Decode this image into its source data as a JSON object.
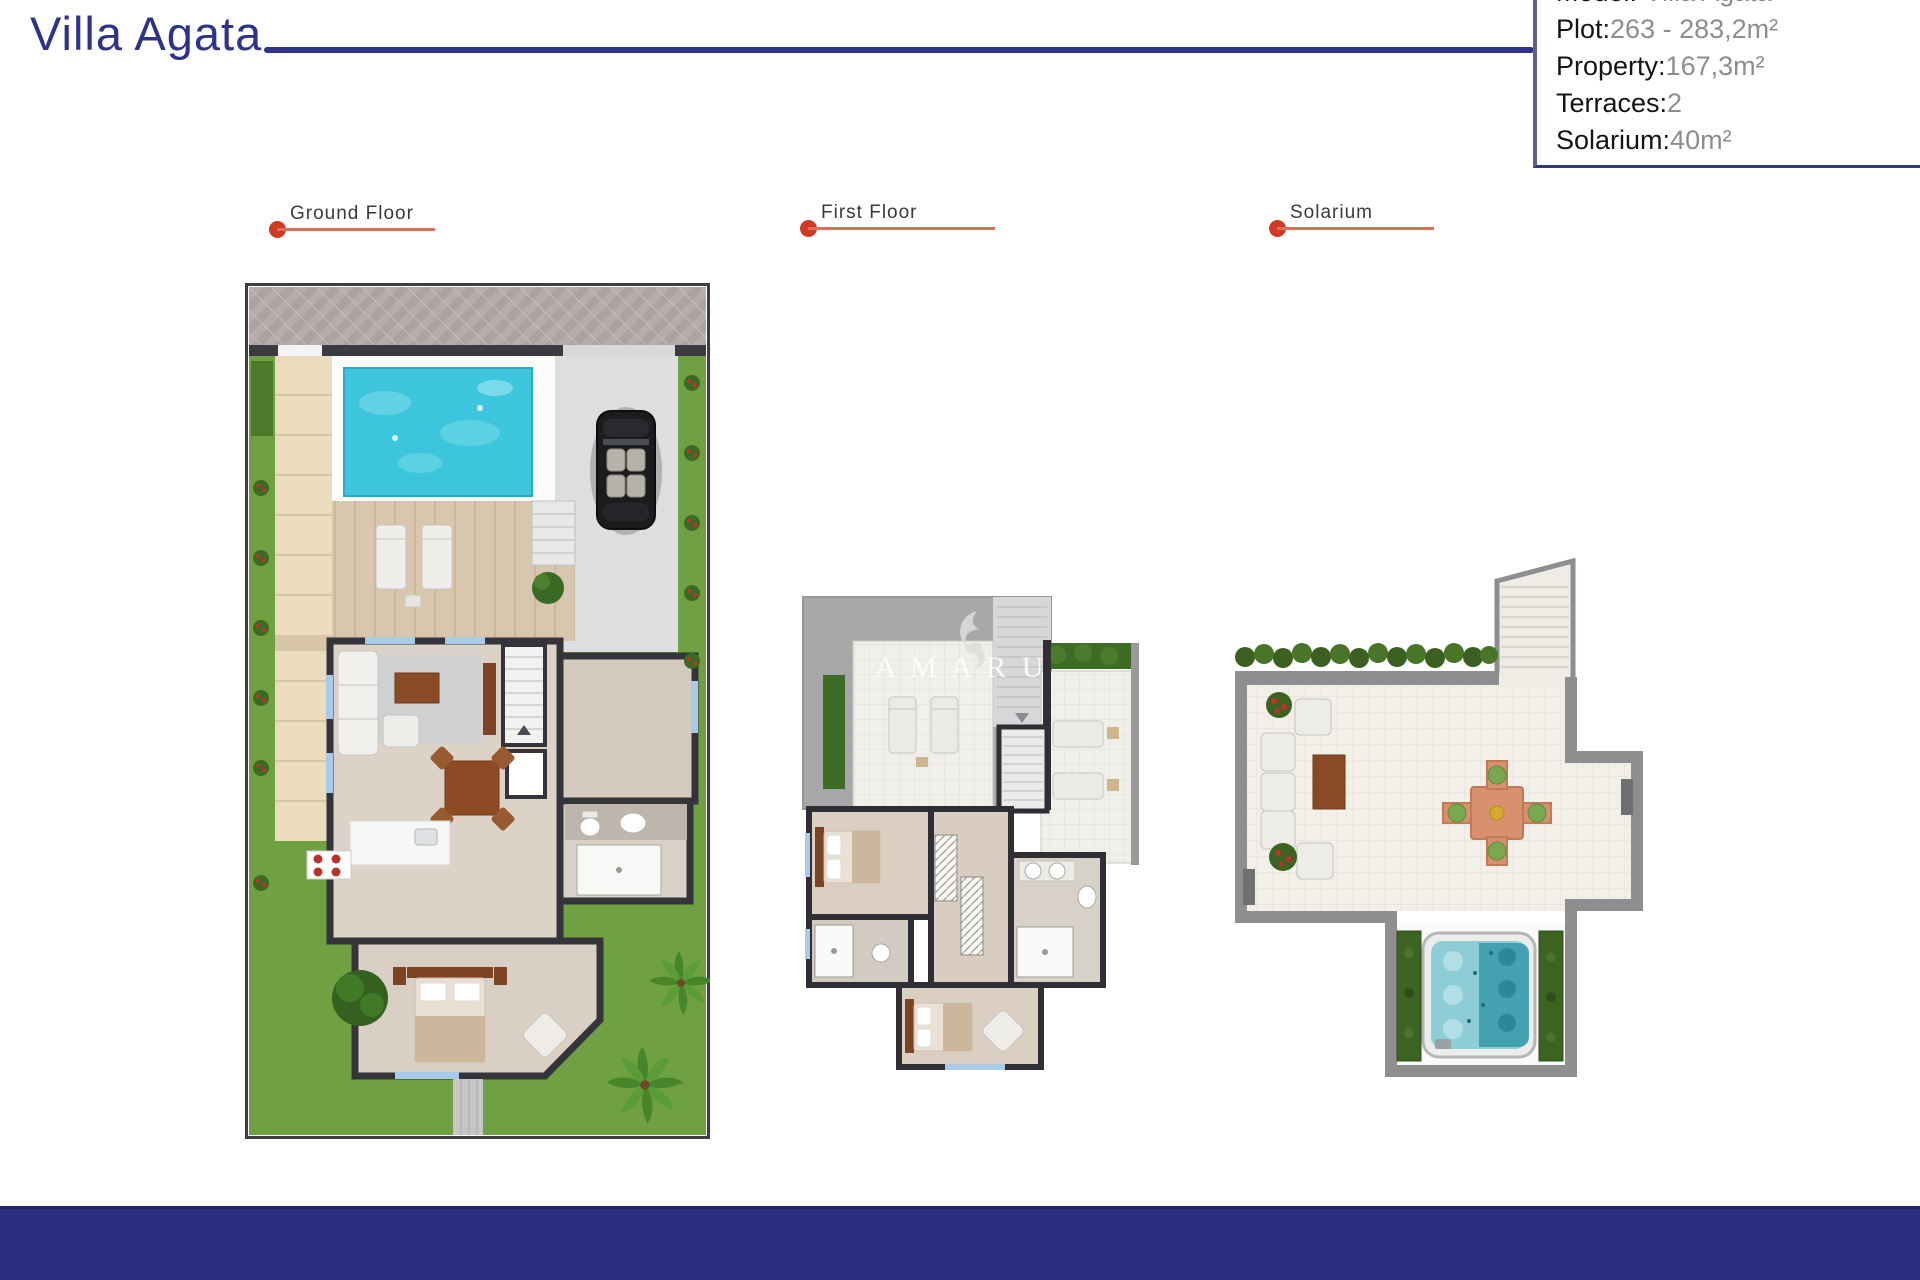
{
  "page": {
    "title": "Villa Agata"
  },
  "colors": {
    "navy": "#2d3389",
    "red_dot": "#ce3a23",
    "red_underline": "#dc6f58"
  },
  "info_box": {
    "rows": [
      {
        "label": "Model:",
        "value": " Villa Agata"
      },
      {
        "label": "Plot:",
        "value": "263 - 283,2m²"
      },
      {
        "label": "Property:",
        "value": "167,3m²"
      },
      {
        "label": "Terraces:",
        "value": "2"
      },
      {
        "label": "Solarium:",
        "value": "40m²"
      }
    ]
  },
  "plan_labels": {
    "ground": "Ground Floor",
    "first": "First Floor",
    "solarium": "Solarium"
  },
  "watermark": "A M A R U"
}
